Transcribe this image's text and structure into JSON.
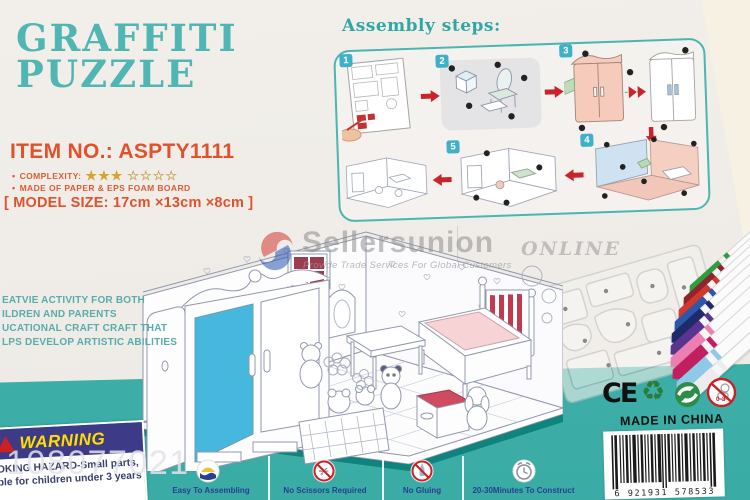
{
  "colors": {
    "teal_strip": "#3cb0aa",
    "title_teal": "#50b6b4",
    "accent_red": "#e1512b",
    "warning_navy": "#3d3a87",
    "warning_yellow": "#ffdf00",
    "arrow_red": "#c9242a"
  },
  "header": {
    "title_line1": "GRAFFITI",
    "title_line2": "PUZZLE"
  },
  "item": {
    "item_no": "ITEM NO.: ASPTY1111",
    "complexity_label": "COMPLEXITY:",
    "stars_filled": "★★★",
    "stars_empty": "☆☆☆☆",
    "material": "MADE OF PAPER & EPS FOAM BOARD",
    "model_size": "[ MODEL SIZE: 17cm ×13cm ×8cm ]"
  },
  "assembly": {
    "title": "Assembly steps:",
    "step_numbers": [
      "1",
      "2",
      "3",
      "4",
      "5"
    ]
  },
  "features": {
    "lines": [
      "EATVIE ACTIVITY FOR BOTH",
      "ILDREN AND PARENTS",
      "UCATIONAL CRAFT CRAFT THAT",
      "LPS DEVELOP ARTISTIC ABILITIES"
    ]
  },
  "watermark": {
    "brand": "Sellersunion",
    "brand_suffix": "ONLINE",
    "tagline": "Provide Trade Services For Global Customers",
    "overlay_number": "108077021"
  },
  "warning": {
    "title": "WARNING",
    "line1": "OKING HAZARD-Small parts,",
    "line2": "ble for children under 3 years"
  },
  "bottom_strip": {
    "items": [
      {
        "icon": "easy-assembly-icon",
        "label": "Easy To Assembling"
      },
      {
        "icon": "no-scissors-icon",
        "label": "No Scissors Required"
      },
      {
        "icon": "no-gluing-icon",
        "label": "No Gluing"
      },
      {
        "icon": "clock-icon",
        "label": "20-30Minutes To Construct"
      }
    ]
  },
  "certifications": {
    "ce": "CE",
    "made_in": "MADE IN CHINA",
    "barcode_digits": "6 921931 578533",
    "age_label": "0-3",
    "recycle_glyph": "♻",
    "scissors_glyph": "✂"
  },
  "pens": {
    "colors": [
      "#2f9e3f",
      "#8e2430",
      "#d2392c",
      "#2b58a8",
      "#1f2a6b",
      "#5a3590",
      "#ec7fb2",
      "#c21f5e",
      "#8fc9e8",
      "#ececec"
    ]
  }
}
